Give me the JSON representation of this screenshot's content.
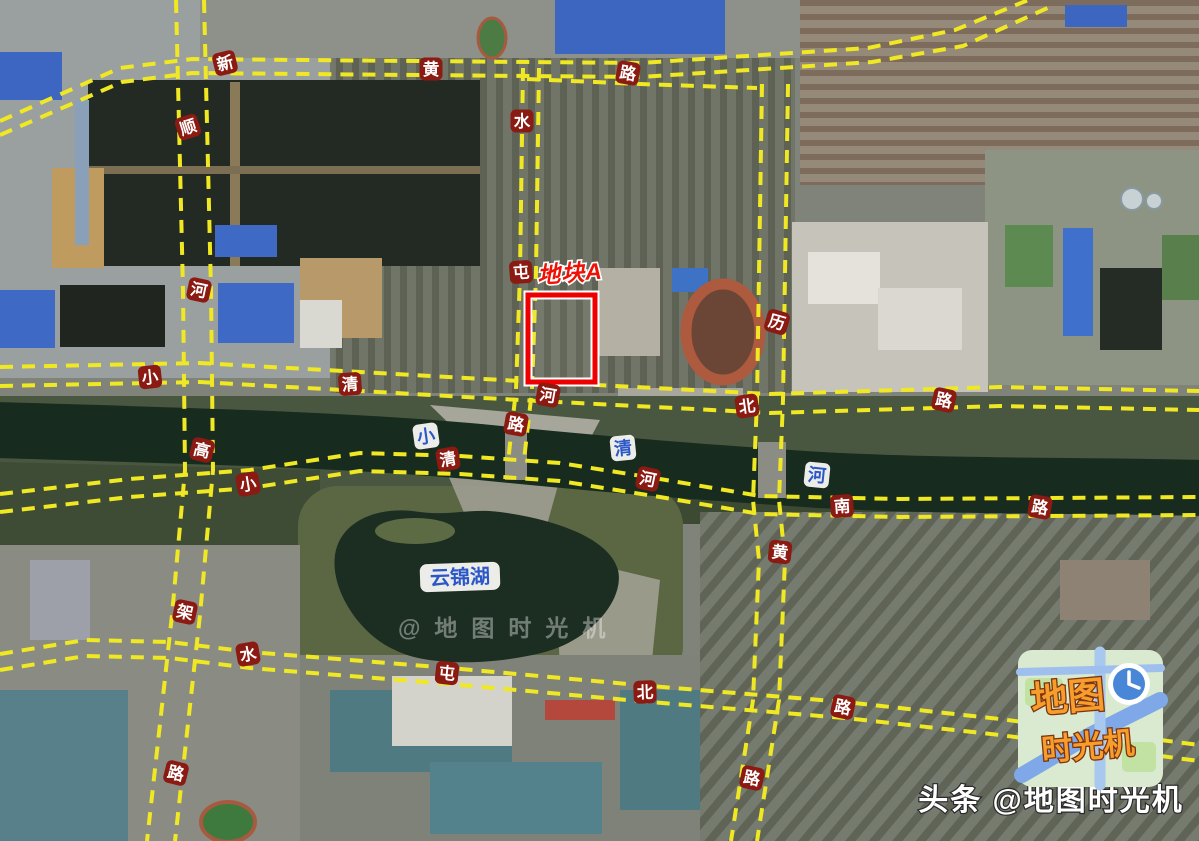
{
  "annotation": {
    "plot_label": "地块A"
  },
  "roads": [
    {
      "name": "新黄路",
      "chars": [
        {
          "t": "新",
          "x": 225,
          "y": 63,
          "r": -14
        },
        {
          "t": "黄",
          "x": 431,
          "y": 69,
          "r": 0
        },
        {
          "t": "路",
          "x": 628,
          "y": 73,
          "r": 10
        }
      ]
    },
    {
      "name": "顺河高架路",
      "chars": [
        {
          "t": "顺",
          "x": 188,
          "y": 127,
          "r": -18
        },
        {
          "t": "河",
          "x": 199,
          "y": 290,
          "r": 12
        },
        {
          "t": "高",
          "x": 202,
          "y": 450,
          "r": 14
        },
        {
          "t": "架",
          "x": 185,
          "y": 612,
          "r": 12
        },
        {
          "t": "路",
          "x": 176,
          "y": 773,
          "r": 14
        }
      ]
    },
    {
      "name": "水屯路",
      "chars": [
        {
          "t": "水",
          "x": 522,
          "y": 121,
          "r": 0
        },
        {
          "t": "屯",
          "x": 521,
          "y": 272,
          "r": -4
        },
        {
          "t": "路",
          "x": 516,
          "y": 424,
          "r": 10
        }
      ]
    },
    {
      "name": "小清河北路",
      "chars": [
        {
          "t": "小",
          "x": 150,
          "y": 377,
          "r": -6
        },
        {
          "t": "清",
          "x": 350,
          "y": 384,
          "r": -4
        },
        {
          "t": "河",
          "x": 548,
          "y": 395,
          "r": 10
        },
        {
          "t": "北",
          "x": 747,
          "y": 406,
          "r": -8
        },
        {
          "t": "路",
          "x": 944,
          "y": 400,
          "r": 12
        }
      ]
    },
    {
      "name": "小清河南路",
      "chars": [
        {
          "t": "小",
          "x": 248,
          "y": 484,
          "r": -10
        },
        {
          "t": "清",
          "x": 448,
          "y": 459,
          "r": -10
        },
        {
          "t": "河",
          "x": 648,
          "y": 479,
          "r": 12
        },
        {
          "t": "南",
          "x": 842,
          "y": 506,
          "r": -4
        },
        {
          "t": "路",
          "x": 1040,
          "y": 507,
          "r": 10
        }
      ]
    },
    {
      "name": "历黄路",
      "chars": [
        {
          "t": "历",
          "x": 777,
          "y": 322,
          "r": 16
        },
        {
          "t": "黄",
          "x": 780,
          "y": 552,
          "r": 6
        },
        {
          "t": "路",
          "x": 752,
          "y": 778,
          "r": 12
        }
      ]
    },
    {
      "name": "水屯北路",
      "chars": [
        {
          "t": "水",
          "x": 248,
          "y": 654,
          "r": -10
        },
        {
          "t": "屯",
          "x": 447,
          "y": 673,
          "r": 6
        },
        {
          "t": "北",
          "x": 645,
          "y": 692,
          "r": -2
        },
        {
          "t": "路",
          "x": 843,
          "y": 707,
          "r": 12
        }
      ]
    }
  ],
  "waterways": {
    "river": {
      "name": "小清河",
      "chars": [
        {
          "t": "小",
          "x": 426,
          "y": 436,
          "r": -8
        },
        {
          "t": "清",
          "x": 623,
          "y": 448,
          "r": -6
        },
        {
          "t": "河",
          "x": 817,
          "y": 475,
          "r": 6
        }
      ]
    },
    "lake": {
      "name": "云锦湖",
      "x": 460,
      "y": 577
    }
  },
  "watermarks": {
    "center": "@地图时光机",
    "bottom": "头条 @地图时光机"
  },
  "logo": {
    "line1": "地图",
    "line2": "时光机",
    "icon": "clock-icon"
  },
  "colors": {
    "road_dash": "#f0e822",
    "road_badge": "#8a1a12",
    "badge_text": "#ffffff",
    "water_text": "#2b57c8",
    "water_badge": "#f8f8f4",
    "plot_highlight": "#ee0000",
    "river_water": "#182b1f"
  }
}
